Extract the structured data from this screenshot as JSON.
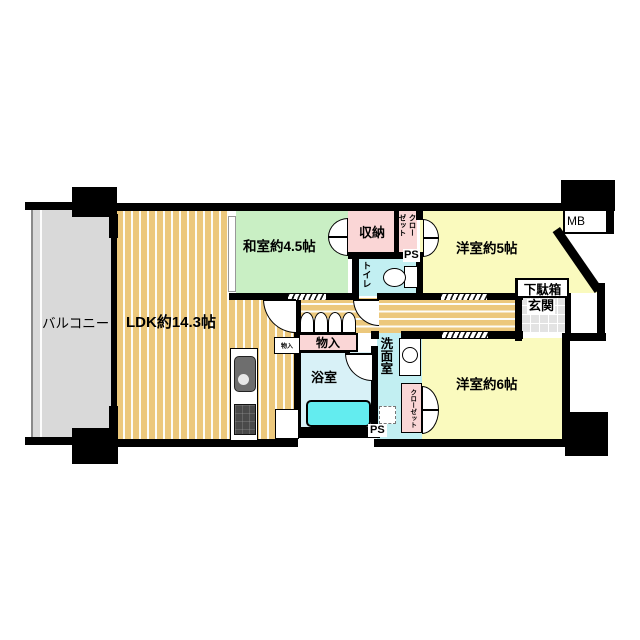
{
  "title": "マンション間取り図 3LDK",
  "rooms": {
    "balcony": "バルコニー",
    "ldk": "LDK約14.3帖",
    "japanese_room": "和室約4.5帖",
    "western_room_5": "洋室約5帖",
    "western_room_6": "洋室約6帖",
    "storage": "収納",
    "closet_upper": "クロー\nゼット",
    "closet_lower": "クローゼット",
    "toilet": "トイレ",
    "washroom": "洗面室",
    "bathroom": "浴室",
    "hall_storage": "物入",
    "small_storage": "物入",
    "entrance": "玄関",
    "shoe_cabinet": "下駄箱",
    "meter_box": "MB",
    "pipe_space_upper": "PS",
    "pipe_space_lower": "PS"
  },
  "colors": {
    "wall": "#000000",
    "wood": "#ecc87c",
    "tatami": "#c9efc4",
    "western": "#fafabe",
    "closet_pink": "#fad6d6",
    "water_cyan": "#c2eff2",
    "bath_floor": "#d8f1f7",
    "bathtub": "#63ecef",
    "balcony_gray": "#d9d9d9",
    "entrance_tile": "#e3e3e3"
  }
}
